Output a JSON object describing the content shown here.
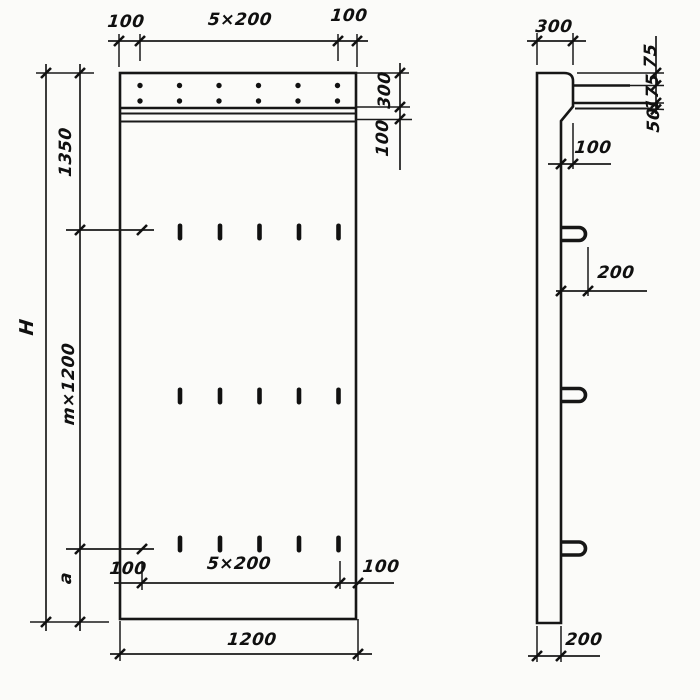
{
  "front_view": {
    "dims_top": {
      "left": "100",
      "middle": "5×200",
      "right": "100"
    },
    "dims_left": {
      "upper": "1350",
      "middle": "m×1200",
      "lower": "a",
      "overall": "H"
    },
    "dims_right": {
      "upper": "300",
      "lower": "100"
    },
    "dims_bottom_inner": {
      "left": "100",
      "middle": "5×200",
      "right": "100"
    },
    "dims_bottom_overall": "1200",
    "anchor_dot_rows": 2,
    "anchor_dots_per_row": 6,
    "slot_rows": 3,
    "slots_per_row": 5
  },
  "side_view": {
    "dim_top_width": "300",
    "dims_right": {
      "first": "75",
      "second": "175",
      "third": "50"
    },
    "dim_ledge_offset": "100",
    "dim_loop_offset": "200",
    "dim_bottom_thickness": "200",
    "lifting_loops": 3
  }
}
